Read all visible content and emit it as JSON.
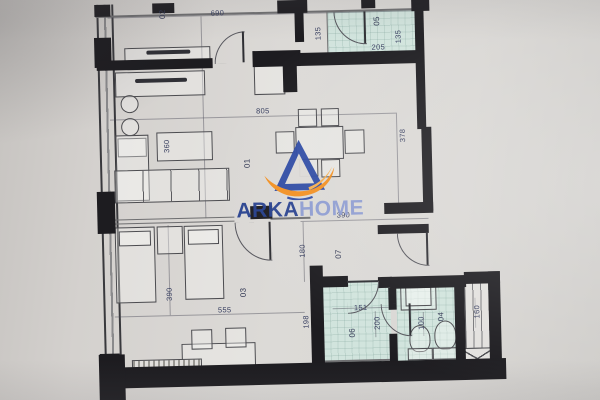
{
  "logo": {
    "word_primary": "ARKA",
    "word_secondary": "HOME",
    "blue": "#27418f",
    "light_blue": "#8c9bd1",
    "orange": "#f38f1d"
  },
  "palette": {
    "paper": "#d9d7d4",
    "wall": "#1d1c20",
    "teal_floor": "#d1e4dd",
    "dim_text": "#394061"
  },
  "rooms": [
    {
      "label": "01"
    },
    {
      "label": "02"
    },
    {
      "label": "03"
    },
    {
      "label": "04"
    },
    {
      "label": "05"
    },
    {
      "label": "06"
    },
    {
      "label": "07"
    }
  ],
  "dims": [
    "690",
    "135",
    "205",
    "135",
    "805",
    "378",
    "360",
    "390",
    "180",
    "390",
    "555",
    "198",
    "151",
    "200",
    "100",
    "160"
  ]
}
